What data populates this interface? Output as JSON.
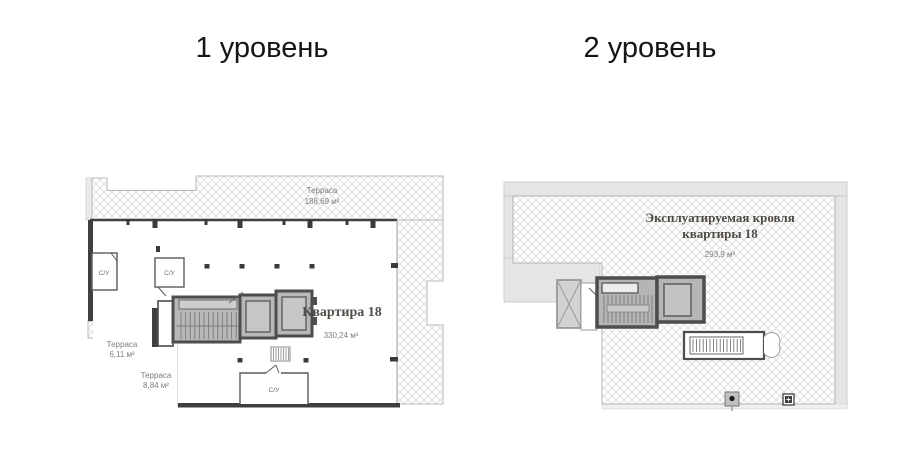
{
  "titles": {
    "level1": "1 уровень",
    "level2": "2 уровень"
  },
  "level1": {
    "terrace_top": {
      "label": "Терраса",
      "area": "188,69 м²"
    },
    "apartment": {
      "label": "Квартира 18",
      "area": "330,24 м²"
    },
    "terrace_left": {
      "label": "Терраса",
      "area": "6,11 м²"
    },
    "terrace_bottom": {
      "label": "Терраса",
      "area": "8,84 м²"
    },
    "bathroom_left": {
      "label": "С/У"
    },
    "bathroom_middle": {
      "label": "С/У"
    },
    "bathroom_bottom": {
      "label": "С/У"
    }
  },
  "level2": {
    "roof": {
      "label_line1": "Эксплуатируемая кровля",
      "label_line2": "квартиры 18",
      "area": "293,9 м²"
    }
  },
  "colors": {
    "background": "#ffffff",
    "hatch_line": "#dcdcdc",
    "band_gray": "#e5e5e5",
    "wall_dark": "#3f3f3f",
    "core_border": "#4d4d4d",
    "core_fill": "#b8b8b8",
    "area_label_gray": "#7d7d7d",
    "serif_label": "#544e48",
    "title_color": "#151515"
  }
}
